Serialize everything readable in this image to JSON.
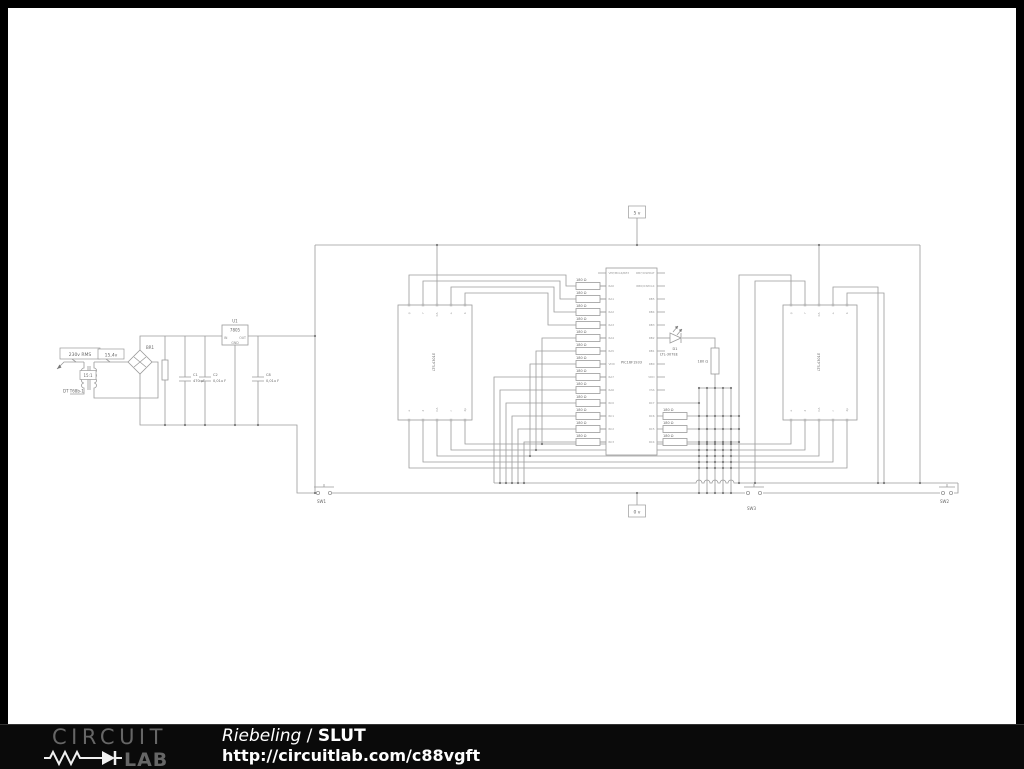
{
  "schematic": {
    "power": {
      "ac_flag": "230v RMS",
      "sec_flag": "15,4v",
      "xfmr_ratio": "15:1",
      "xfmr_label": "DT T68b-1",
      "bridge_name": "BR1",
      "reg_name": "U1",
      "reg_value": "7805",
      "pin_in": "IN",
      "pin_out": "OUT",
      "pin_gnd": "GND",
      "c1_name": "C1",
      "c1_value": "470 µF",
      "c2_name": "C2",
      "c2_value": "0,01u F",
      "c8_name": "C8",
      "c8_value": "0,01u F"
    },
    "flags": {
      "vcc": "5 v",
      "gnd": "0 v"
    },
    "mcu": {
      "part": "PIC16F1933",
      "left_pins": [
        "VPP/MCLR/RE3",
        "RA0",
        "RA1",
        "RA2",
        "RA3",
        "RA4",
        "RA5",
        "VDD",
        "RA7",
        "RA6",
        "RC0",
        "RC1",
        "RC2",
        "RC3"
      ],
      "right_pins": [
        "RB7/ICSPDAT",
        "RB6/ICSPCLK",
        "RB5",
        "RB4",
        "RB3",
        "RB2",
        "RB1",
        "RB0",
        "VDD",
        "VSS",
        "RC7",
        "RC6",
        "RC5",
        "RC4"
      ]
    },
    "r_value": "180 Ω",
    "led": {
      "name": "D1",
      "part": "LTL-307EE"
    },
    "displays": {
      "part": "LTS-4301E",
      "top_pins": [
        "g",
        "f",
        "CA",
        "a",
        "b"
      ],
      "bottom_pins": [
        "e",
        "d",
        "CA",
        "c",
        "dp"
      ]
    },
    "switches": {
      "sw1": "SW1",
      "sw2": "SW2",
      "sw3": "SW3"
    }
  },
  "footer": {
    "brand_top": "CIRCUIT",
    "brand_bottom": "LAB",
    "author": "Riebeling",
    "separator": " / ",
    "project": "SLUT",
    "url": "http://circuitlab.com/c88vgft"
  }
}
